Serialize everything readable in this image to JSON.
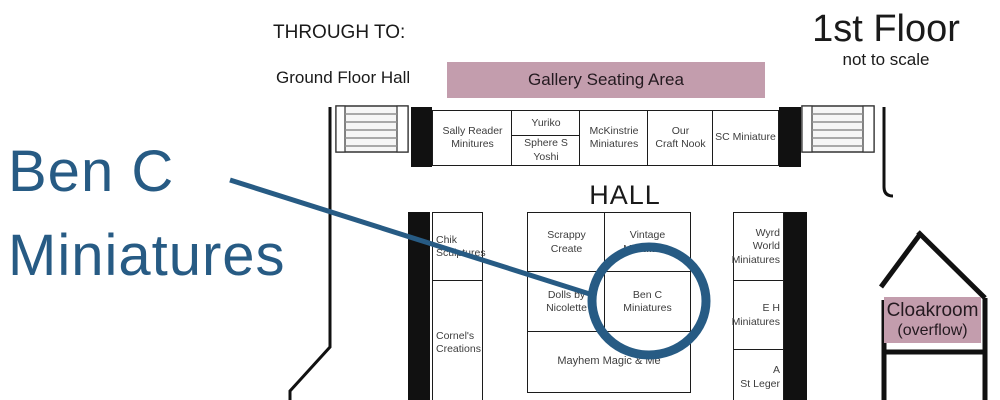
{
  "annotation": {
    "line1": "Ben C",
    "line2": "Miniatures",
    "accent_color": "#275b84"
  },
  "header": {
    "through_to": "THROUGH TO:",
    "ground_floor": "Ground Floor Hall",
    "floor_title": "1st Floor",
    "floor_subtitle": "not to scale"
  },
  "areas": {
    "gallery_label": "Gallery Seating Area",
    "hall_label": "HALL",
    "cloakroom_line1": "Cloakroom",
    "cloakroom_line2": "(overflow)",
    "area_pink": "#c39dad"
  },
  "booths": {
    "sally": {
      "label": "Sally Reader\nMinitures"
    },
    "yuriko": {
      "label": "Yuriko"
    },
    "sphere": {
      "label": "Sphere S\nYoshi"
    },
    "mckinstrie": {
      "label": "McKinstrie\nMiniatures"
    },
    "craft_nook": {
      "label": "Our\nCraft Nook"
    },
    "sc_miniature": {
      "label": "SC Miniature"
    },
    "chik": {
      "label": "Chik\nSculptures"
    },
    "cornel": {
      "label": "Cornel's\nCreations"
    },
    "scrappy": {
      "label": "Scrappy\nCreate"
    },
    "vintage": {
      "label": "Vintage\nMiniatures"
    },
    "dolls": {
      "label": "Dolls by\nNicolette"
    },
    "ben_c": {
      "label": "Ben C\nMiniatures"
    },
    "mayhem": {
      "label": "Mayhem Magic & Me"
    },
    "wyrd": {
      "label": "Wyrd\nWorld\nMiniatures"
    },
    "eh": {
      "label": "E H\nMiniatures"
    },
    "st_leger": {
      "label": "A\nSt Leger"
    }
  }
}
